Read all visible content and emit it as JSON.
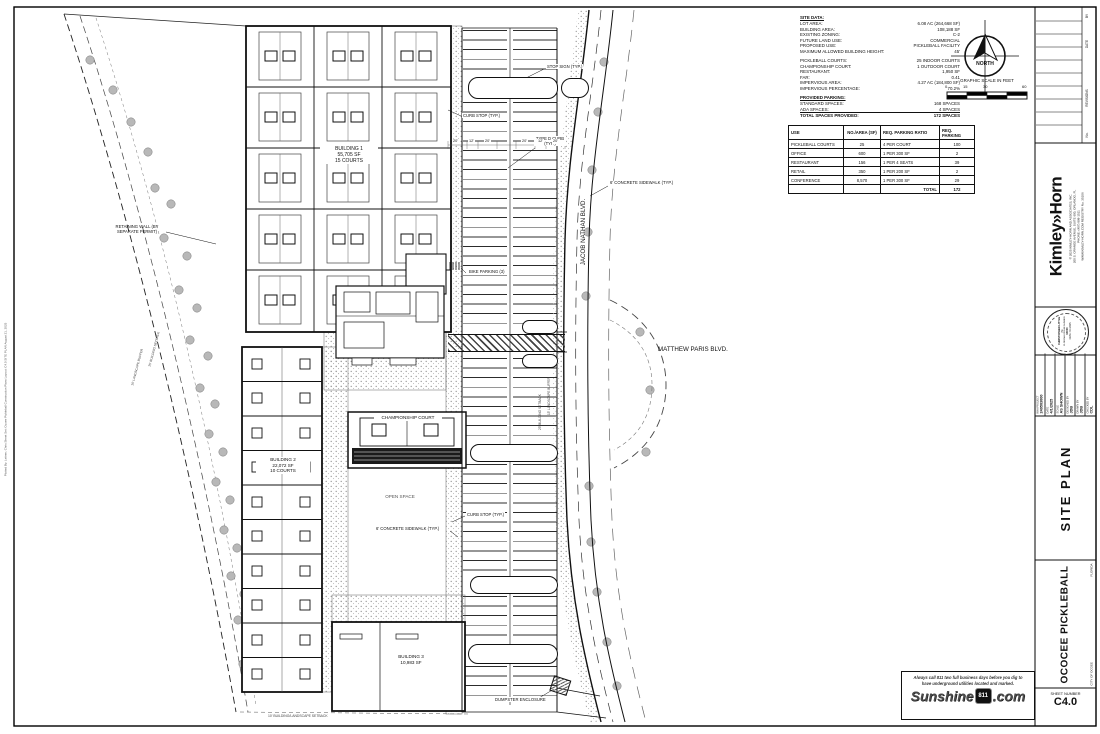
{
  "page": {
    "plot_info": "Plotted By: Leitner, Chris   Sheet Set: Ocoee Pickleball Construction Plans   Layout: C4.0 SITE PLAN   August 21, 2025"
  },
  "site_data": {
    "title": "SITE DATA:",
    "general": [
      {
        "label": "LOT AREA:",
        "value": "6.08 AC (264,668 SF)"
      },
      {
        "label": "BUILDING AREA:",
        "value": "108,188 SF"
      },
      {
        "label": "EXISTING ZONING:",
        "value": "C-2"
      },
      {
        "label": "FUTURE LAND USE:",
        "value": "COMMERCIAL"
      },
      {
        "label": "PROPOSED USE:",
        "value": "PICKLEBALL FACILITY"
      },
      {
        "label": "MAXIMUM ALLOWED BUILDING HEIGHT:",
        "value": "45'"
      }
    ],
    "program": [
      {
        "label": "PICKLEBALL COURTS:",
        "value": "25 INDOOR COURTS"
      },
      {
        "label": "CHAMPIONSHIP COURT:",
        "value": "1 OUTDOOR COURT"
      },
      {
        "label": "RESTAURANT:",
        "value": "1,950 SF"
      },
      {
        "label": "FAR:",
        "value": "0.41"
      },
      {
        "label": "IMPERVIOUS AREA:",
        "value": "4.27 AC (184,800 SF)"
      },
      {
        "label": "IMPERVIOUS PERCENTAGE:",
        "value": "70.2%"
      }
    ],
    "parking_title": "PROVIDED PARKING:",
    "parking": [
      {
        "label": "STANDARD SPACES:",
        "value": "168 SPACES"
      },
      {
        "label": "ADA SPACES:",
        "value": "4 SPACES"
      },
      {
        "label": "TOTAL SPACES PROVIDED:",
        "value": "172 SPACES"
      }
    ]
  },
  "parking_table": {
    "headers": [
      "USE",
      "NO./AREA (SF)",
      "REQ. PARKING RATIO",
      "REQ. PARKING"
    ],
    "rows": [
      [
        "PICKLEBALL COURTS",
        "25",
        "4 PER COURT",
        "100"
      ],
      [
        "OFFICE",
        "600",
        "1 PER 300 SF",
        "2"
      ],
      [
        "RESTAURANT",
        "156",
        "1 PER 4 SEATS",
        "39"
      ],
      [
        "RETAIL",
        "350",
        "1 PER 200 SF",
        "2"
      ],
      [
        "CONFERENCE",
        "8,570",
        "1 PER 300 SF",
        "29"
      ],
      [
        "",
        "",
        "TOTAL",
        "172"
      ]
    ]
  },
  "north": {
    "label": "NORTH"
  },
  "scale_bar": {
    "title": "GRAPHIC SCALE IN FEET",
    "ticks": [
      "0",
      "15",
      "30",
      "60"
    ]
  },
  "plan": {
    "buildings": {
      "b1_name": "BUILDING 1",
      "b1_area": "55,705 SF",
      "b1_courts": "15 COURTS",
      "b2_name": "BUILDING 2",
      "b2_area": "22,072 SF",
      "b2_courts": "10 COURTS",
      "b3_name": "BUILDING 3",
      "b3_area": "10,983 SF"
    },
    "labels": {
      "stop_sign": "STOP SIGN (TYP.)",
      "curb_stop_top": "CURB STOP (TYP.)",
      "type_d_curb": "TYPE D CURB (TYP.)",
      "sidewalk_right": "6' CONCRETE SIDEWALK (TYP.)",
      "bike_parking": "BIKE PARKING (3)",
      "retaining_wall": "RETAINING WALL (BY SEPARATE PERMIT)",
      "championship_court": "CHAMPIONSHIP COURT",
      "open_space": "OPEN SPACE",
      "curb_stop_mid": "CURB STOP (TYP.)",
      "sidewalk_mid": "6' CONCRETE SIDEWALK (TYP.)",
      "dumpster": "DUMPSTER ENCLOSURE",
      "jacob_nathan_blvd": "JACOB NATHAN BLVD.",
      "matthew_paris_blvd": "MATTHEW PARIS BLVD.",
      "landscape_buffer_10": "10' LANDSCAPE BUFFER",
      "building_setback_25": "25' BUILDING SETBACK",
      "landscape_buffer_15": "15' LANDSCAPE BUFFER",
      "building_setback_25_e": "25' BUILDING SETBACK",
      "setback_bottom": "10' BUILDING/LANDSCAPE SETBACK"
    },
    "dims": [
      "20'",
      "12'",
      "20'",
      "20'",
      "12'",
      "20'"
    ]
  },
  "title_block": {
    "revisions": {
      "no_label": "No.",
      "revisions_label": "REVISIONS",
      "date_label": "DATE",
      "by_label": "BY"
    },
    "firm": {
      "logo": "Kimley»Horn",
      "copyright": "© 2025 KIMLEY-HORN AND ASSOCIATES, INC.",
      "address": "200 S. ORANGE AVENUE, SUITE 600, ORLANDO, FL",
      "phone": "PHONE: (407) 898-1511",
      "web": "WWW.KIMLEY-HORN.COM    REGISTRY No. 35106"
    },
    "seal": {
      "name": "CHRISTOPHER LITTLE",
      "title": "PE",
      "license": "FLORIDA LICENSE NUMBER",
      "number": "93000",
      "date": "DATE: 4/1/2025"
    },
    "project_info": [
      {
        "label": "KHA PROJECT",
        "value": "249503000"
      },
      {
        "label": "DATE",
        "value": "4/1/2025"
      },
      {
        "label": "SCALE",
        "value": "AS SHOWN"
      },
      {
        "label": "DESIGNED BY",
        "value": "JDB"
      },
      {
        "label": "DRAWN BY",
        "value": "JDB"
      },
      {
        "label": "CHECKED BY",
        "value": "CDL"
      }
    ],
    "sheet_title": "SITE PLAN",
    "project_name": "OCOCEE PICKLEBALL",
    "state": "FLORIDA",
    "city": "CITY OF OCOEE",
    "sheet_number_label": "SHEET NUMBER",
    "sheet_number": "C4.0"
  },
  "sunshine": {
    "line1": "Always call 811 two full business days before you dig to",
    "line2": "have underground utilities located and marked.",
    "brand": "Sunshine",
    "shield": "811",
    "suffix": ".com"
  }
}
